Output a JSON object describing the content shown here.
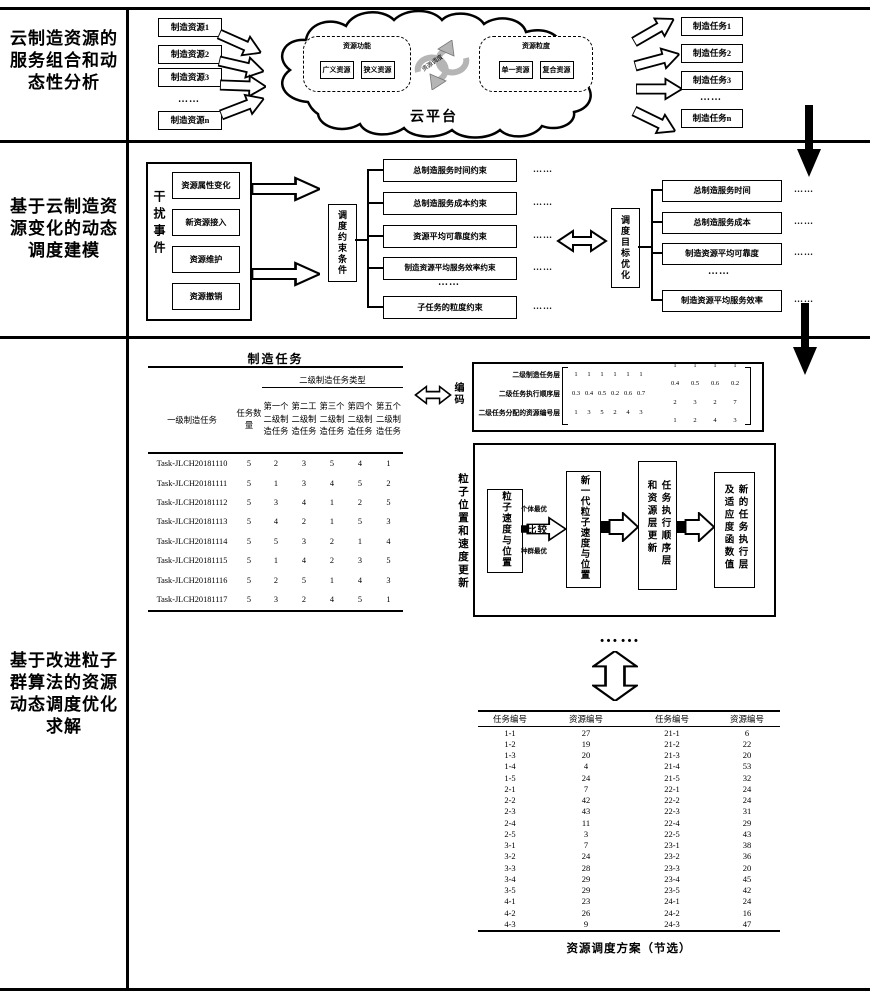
{
  "palette": {
    "ink": "#000000",
    "paper": "#ffffff",
    "arrow_gray": "#b5b5b5"
  },
  "left_titles": {
    "s1": "云制造资源的服务组合和动态性分析",
    "s2": "基于云制造资源变化的动态调度建模",
    "s3": "基于改进粒子群算法的资源动态调度优化求解"
  },
  "section1": {
    "resources": [
      "制造资源1",
      "制造资源2",
      "制造资源3",
      "……",
      "制造资源n"
    ],
    "tasks": [
      "制造任务1",
      "制造任务2",
      "制造任务3",
      "……",
      "制造任务n"
    ],
    "cloud": {
      "platform_label": "云平台",
      "cycle_label": "资源调度",
      "function_group": {
        "title": "资源功能",
        "items": [
          "广义资源",
          "狭义资源"
        ]
      },
      "granularity_group": {
        "title": "资源粒度",
        "items": [
          "单一资源",
          "复合资源"
        ]
      }
    }
  },
  "section2": {
    "disturbance": {
      "label": "干扰事件",
      "events": [
        "资源属性变化",
        "新资源接入",
        "资源维护",
        "资源撤销"
      ]
    },
    "constraint_hub": "调度约束条件",
    "constraints": [
      "总制造服务时间约束",
      "总制造服务成本约束",
      "资源平均可靠度约束",
      "制造资源平均服务效率约束",
      "子任务的粒度约束"
    ],
    "objective_hub": "调度目标优化",
    "objectives": [
      "总制造服务时间",
      "总制造服务成本",
      "制造资源平均可靠度",
      "制造资源平均服务效率"
    ],
    "ellipsis": "……"
  },
  "section3": {
    "task_table": {
      "title": "制造任务",
      "group_header": "二级制造任务类型",
      "col_primary": "一级制造任务",
      "col_count": "任务数量",
      "sub_cols": [
        "第一个二级制造任务",
        "第二工二级制造任务",
        "第三个二级制造任务",
        "第四个二级制造任务",
        "第五个二级制造任务"
      ],
      "rows": [
        [
          "Task-JLCH20181110",
          "5",
          "2",
          "3",
          "5",
          "4",
          "1"
        ],
        [
          "Task-JLCH20181111",
          "5",
          "1",
          "3",
          "4",
          "5",
          "2"
        ],
        [
          "Task-JLCH20181112",
          "5",
          "3",
          "4",
          "1",
          "2",
          "5"
        ],
        [
          "Task-JLCH20181113",
          "5",
          "4",
          "2",
          "1",
          "5",
          "3"
        ],
        [
          "Task-JLCH20181114",
          "5",
          "5",
          "3",
          "2",
          "1",
          "4"
        ],
        [
          "Task-JLCH20181115",
          "5",
          "1",
          "4",
          "2",
          "3",
          "5"
        ],
        [
          "Task-JLCH20181116",
          "5",
          "2",
          "5",
          "1",
          "4",
          "3"
        ],
        [
          "Task-JLCH20181117",
          "5",
          "3",
          "2",
          "4",
          "5",
          "1"
        ]
      ]
    },
    "encoding": {
      "label": "编码",
      "row_labels": [
        "二级制造任务层",
        "二级任务执行顺序层",
        "二级任务分配的资源编号层"
      ],
      "matrix_left": [
        [
          "1",
          "1",
          "1",
          "1",
          "1",
          "1"
        ],
        [
          "0.3",
          "0.4",
          "0.5",
          "0.2",
          "0.6",
          "0.7"
        ],
        [
          "1",
          "3",
          "5",
          "2",
          "4",
          "3"
        ]
      ],
      "matrix_right": [
        [
          "1",
          "1",
          "1",
          "1"
        ],
        [
          "0.4",
          "0.5",
          "0.6",
          "0.2"
        ],
        [
          "2",
          "3",
          "2",
          "7"
        ],
        [
          "1",
          "2",
          "4",
          "3"
        ]
      ]
    },
    "pso": {
      "label": "粒子位置和速度更新",
      "box_current": "粒子速度与位置",
      "compare_top": "个体最优",
      "compare_mid": "比较",
      "compare_bottom": "种群最优",
      "box_next": "新一代粒子速度与位置",
      "box_update": "任务执行顺序层和资源层更新",
      "box_fitness": "新的任务执行层及适应度函数值"
    },
    "ellipsis": "……",
    "schedule_table": {
      "headers": [
        "任务编号",
        "资源编号",
        "任务编号",
        "资源编号"
      ],
      "rows": [
        [
          "1-1",
          "27",
          "21-1",
          "6"
        ],
        [
          "1-2",
          "19",
          "21-2",
          "22"
        ],
        [
          "1-3",
          "20",
          "21-3",
          "20"
        ],
        [
          "1-4",
          "4",
          "21-4",
          "53"
        ],
        [
          "1-5",
          "24",
          "21-5",
          "32"
        ],
        [
          "2-1",
          "7",
          "22-1",
          "24"
        ],
        [
          "2-2",
          "42",
          "22-2",
          "24"
        ],
        [
          "2-3",
          "43",
          "22-3",
          "31"
        ],
        [
          "2-4",
          "11",
          "22-4",
          "29"
        ],
        [
          "2-5",
          "3",
          "22-5",
          "43"
        ],
        [
          "3-1",
          "7",
          "23-1",
          "38"
        ],
        [
          "3-2",
          "24",
          "23-2",
          "36"
        ],
        [
          "3-3",
          "28",
          "23-3",
          "20"
        ],
        [
          "3-4",
          "29",
          "23-4",
          "45"
        ],
        [
          "3-5",
          "29",
          "23-5",
          "42"
        ],
        [
          "4-1",
          "23",
          "24-1",
          "24"
        ],
        [
          "4-2",
          "26",
          "24-2",
          "16"
        ],
        [
          "4-3",
          "9",
          "24-3",
          "47"
        ]
      ],
      "caption": "资源调度方案（节选）"
    }
  }
}
